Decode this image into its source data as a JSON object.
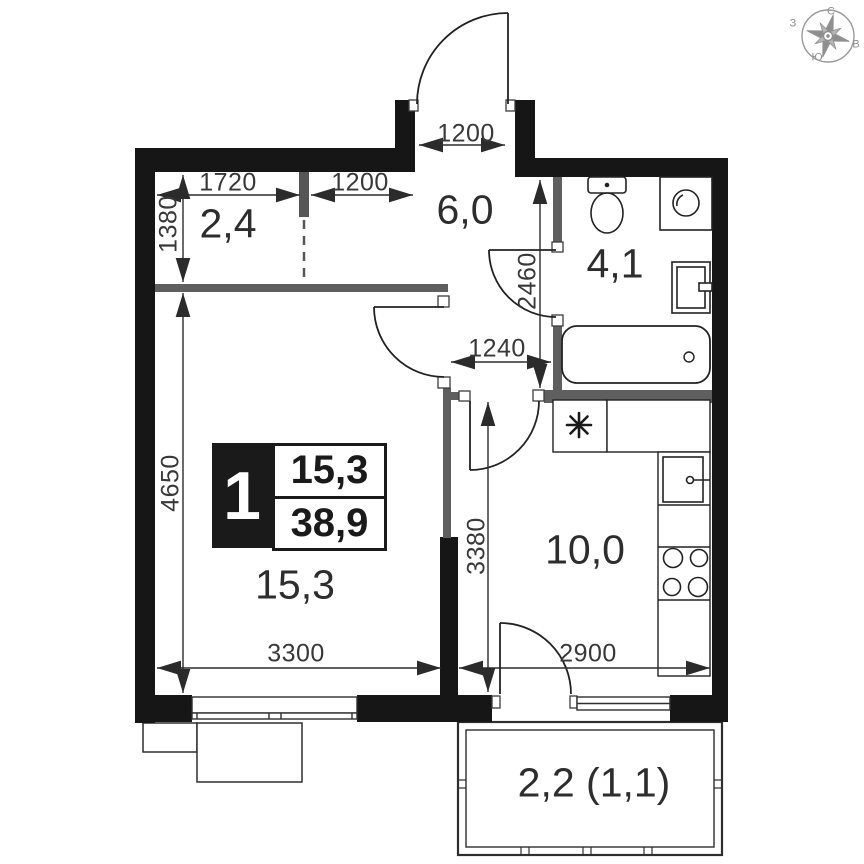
{
  "rooms": {
    "hall": "2,4",
    "corridor": "6,0",
    "bathroom": "4,1",
    "living": "15,3",
    "kitchen": "10,0",
    "balcony": "2,2 (1,1)"
  },
  "badge": {
    "room_count": "1",
    "living_area": "15,3",
    "total_area": "38,9"
  },
  "dims": {
    "hall_width": "1720",
    "hall_entry": "1200",
    "hall_depth": "1380",
    "entrance_width": "1200",
    "corridor_depth": "2460",
    "corridor_width": "1240",
    "living_height": "4650",
    "living_width": "3300",
    "kitchen_height": "3380",
    "kitchen_width": "2900"
  },
  "compass": {
    "north": "С",
    "east": "В",
    "south": "Ю",
    "west": "З"
  },
  "fixtures": [
    "toilet",
    "washing-machine",
    "sink",
    "bathtub",
    "ventilation",
    "kitchen-sink",
    "stove"
  ],
  "colors": {
    "wall": "#161616",
    "partition": "#5f5f5f",
    "line": "#2b2b2b",
    "text": "#2d2d2d",
    "compass": "#8f8f8f"
  }
}
